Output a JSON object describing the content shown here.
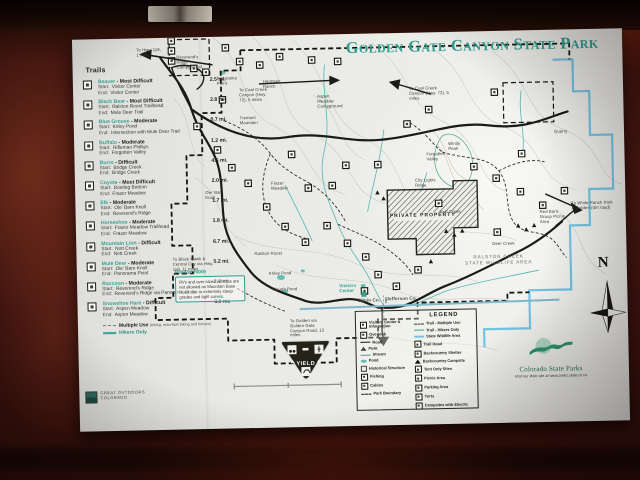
{
  "sign": {
    "title": "Golden Gate Canyon State Park",
    "trails_heading": "Trails",
    "labels": {
      "start": "Start:",
      "end": "End:"
    },
    "trails": [
      {
        "name": "Beaver",
        "difficulty": "- Most Difficult",
        "length": "2.5 mi.",
        "start": "Visitor Center",
        "end": "Visitor Center"
      },
      {
        "name": "Black Bear",
        "difficulty": "- Most Difficult",
        "length": "2.8 mi.",
        "start": "Ralston Roost Trailhead",
        "end": "Mule Deer Trail"
      },
      {
        "name": "Blue Grouse",
        "difficulty": "- Moderate",
        "length": "0.7 mi.",
        "start": "Kriley Pond",
        "end": "Intersection with Mule Deer Trail"
      },
      {
        "name": "Buffalo",
        "difficulty": "- Moderate",
        "length": "1.2 mi.",
        "start": "Rifleman Phillips",
        "end": "Forgotten Valley"
      },
      {
        "name": "Burro",
        "difficulty": "- Difficult",
        "length": "4.5 mi.",
        "start": "Bridge Creek",
        "end": "Bridge Creek"
      },
      {
        "name": "Coyote",
        "difficulty": "- Most Difficult",
        "length": "2.0 mi.",
        "start": "Bootleg Bottom",
        "end": "Frazer Meadow"
      },
      {
        "name": "Elk",
        "difficulty": "- Moderate",
        "length": "1.7 mi.",
        "start": "Ole' Barn Knoll",
        "end": "Reverend's Ridge"
      },
      {
        "name": "Horseshoe",
        "difficulty": "- Moderate",
        "length": "1.8 mi.",
        "start": "Frazer Meadow Trailhead",
        "end": "Frazer Meadow"
      },
      {
        "name": "Mountain Lion",
        "difficulty": "- Difficult",
        "length": "6.7 mi.",
        "start": "Nott Creek",
        "end": "Nott Creek"
      },
      {
        "name": "Mule Deer",
        "difficulty": "- Moderate",
        "length": "5.2 mi.",
        "start": "Ole' Barn Knoll",
        "end": "Panorama Point"
      },
      {
        "name": "Raccoon",
        "difficulty": "- Moderate",
        "length": "2.5 mi.",
        "start": "Reverend's Ridge",
        "end": "Reverend's Ridge via Panorama Point"
      },
      {
        "name": "Snowshoe Hare",
        "difficulty": "- Difficult",
        "length": "3.0 mi.",
        "start": "Aspen Meadow",
        "end": "Aspen Meadow"
      }
    ],
    "trail_types": {
      "multiple_use": "Multiple Use",
      "multiple_use_note": "(hiking, mountain biking and horses)",
      "hikers_only": "Hikers Only"
    },
    "goco": {
      "line1": "Great Outdoors",
      "line2": "Colorado"
    },
    "please_note": {
      "heading": "Please Note",
      "body": "RVs and over-sized vehicles are not allowed on Mountain Base Road due to extremely steep grades and tight curves."
    },
    "map_labels": {
      "to_hwy_119": "To Hwy. 119, 1 mile",
      "reverends_ridge": "Reverend's Ridge Campground",
      "panorama_point": "Panorama Point",
      "harmsen_ranch": "Harmsen Ranch",
      "to_coal_creek_1": "To Coal Creek Canyon (Hwy. 72), 5 miles",
      "to_coal_creek_2": "To Coal Creek Canyon (Hwy. 72), 5 miles",
      "aspen_meadow": "Aspen Meadow Campground",
      "tremont_mountain": "Tremont Mountain",
      "windy_peak": "Windy Peak",
      "forgotten_valley": "Forgotten Valley",
      "city_lights_ridge": "City Lights Ridge",
      "quarry": "Quarry",
      "deer_creek": "Deer Creek",
      "frazer_meadow": "Frazer Meadow",
      "ole_barn_knoll": "Ole' Barn Knoll",
      "kriley_pond": "Kriley Pond",
      "slough_pond": "Slough Pond",
      "ralston_roost": "Ralston Roost",
      "nott_creek": "Nott Creek",
      "red_barn": "Red Barn Group Picnic Area",
      "visitors_center": "Visitors Center",
      "private_property": "PRIVATE PROPERTY",
      "ralston_creek_swa1": "RALSTON CREEK",
      "ralston_creek_swa2": "STATE WILDLIFE AREA",
      "to_white_ranch": "To White Ranch Park & Golden (dirt road)",
      "to_golden": "To Golden via Golden Gate Canyon Road, 13 miles",
      "to_black_hawk": "To Black Hawk & Central City via Hwy. 119, 11 miles",
      "gilpin_co": "Gilpin Co.",
      "jefferson_co": "Jefferson Co.",
      "compass_n": "N",
      "yield": "YIELD"
    },
    "legend": {
      "heading": "LEGEND",
      "left": [
        {
          "icon": "visitors-center-icon",
          "label": "Visitors Center & Information"
        },
        {
          "icon": "overlook-icon",
          "label": "Overlook"
        },
        {
          "icon": "road-line",
          "label": "Road"
        },
        {
          "icon": "peak-icon",
          "label": "Peak"
        },
        {
          "icon": "stream-line",
          "label": "Stream"
        },
        {
          "icon": "pond-icon",
          "label": "Pond"
        },
        {
          "icon": "historical-structure-icon",
          "label": "Historical Structure"
        },
        {
          "icon": "fishing-icon",
          "label": "Fishing"
        },
        {
          "icon": "cabins-icon",
          "label": "Cabins"
        },
        {
          "icon": "park-boundary-line",
          "label": "Park Boundary"
        }
      ],
      "right": [
        {
          "icon": "trail-multiple-use-line",
          "label": "Trail - Multiple Use"
        },
        {
          "icon": "trail-hikers-only-line",
          "label": "Trail - Hikers Only"
        },
        {
          "icon": "state-wildlife-area-line",
          "label": "State Wildlife Area"
        },
        {
          "icon": "trail-head-icon",
          "label": "Trail Head"
        },
        {
          "icon": "backcountry-shelter-icon",
          "label": "Backcountry Shelter"
        },
        {
          "icon": "backcountry-campsite-icon",
          "label": "Backcountry Campsite"
        },
        {
          "icon": "tent-only-sites-icon",
          "label": "Tent Only Sites"
        },
        {
          "icon": "picnic-area-icon",
          "label": "Picnic Area"
        },
        {
          "icon": "parking-area-icon",
          "label": "Parking Area"
        },
        {
          "icon": "yurts-icon",
          "label": "Yurts"
        },
        {
          "icon": "campsites-with-electric-icon",
          "label": "Campsites with Electric"
        }
      ]
    },
    "csp": {
      "brand": "Colorado State Parks",
      "web": "Visit our Web site at www.parks.state.co.us"
    },
    "colors": {
      "title_teal": "#2f9e8f",
      "stream_teal": "#55b7ad",
      "wildlife_blue": "#74c3e0",
      "paper": "#e8e8e4",
      "board": "#4c1912"
    }
  }
}
